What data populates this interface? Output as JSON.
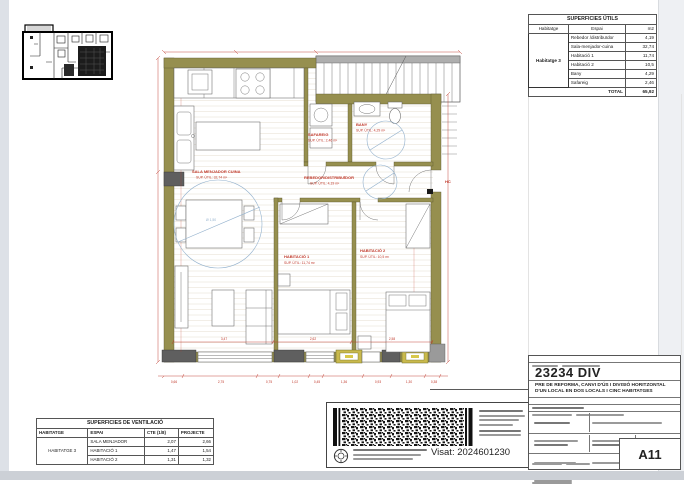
{
  "sheet": {
    "project_number": "23234 DIV",
    "project_description_line1": "PRE DE REFORMA, CANVI D'ÚS I DIVISIÓ HORITZONTAL",
    "project_description_line2": "D'UN LOCAL EN DOS LOCALS I CINC HABITATGES",
    "sheet_number": "A11",
    "visat": "Visat: 2024601230"
  },
  "surfaces_table": {
    "title": "SUPERFICIES ÚTILS",
    "columns": {
      "habitatge": "Habitatge",
      "espai": "Espai",
      "m2": "m2"
    },
    "habitatge": "Habitatge 3",
    "rows": [
      {
        "espai": "Rebedor /distribuïdor",
        "m2": "4,19"
      },
      {
        "espai": "Sala-menjador-cuina",
        "m2": "32,74"
      },
      {
        "espai": "Habitació 1",
        "m2": "11,74"
      },
      {
        "espai": "Habitació 2",
        "m2": "10,5"
      },
      {
        "espai": "Bany",
        "m2": "4,29"
      },
      {
        "espai": "Safareig",
        "m2": "2,46"
      }
    ],
    "total_label": "TOTAL",
    "total_value": "65,92"
  },
  "ventilation_table": {
    "title": "SUPERFICIES DE VENTILACIÓ",
    "columns": {
      "habitatge": "HABITATGE",
      "espai": "ESPAI",
      "cte": "CTE (1/8)",
      "projecte": "PROJECTE"
    },
    "habitatge": "HABITATGE 3",
    "rows": [
      {
        "espai": "SALA MENJADOR",
        "cte": "2,07",
        "projecte": "2,66"
      },
      {
        "espai": "HABITACIÓ 1",
        "cte": "1,47",
        "projecte": "1,54"
      },
      {
        "espai": "HABITACIÓ 2",
        "cte": "1,31",
        "projecte": "1,32"
      }
    ]
  },
  "plan": {
    "rooms": {
      "sala": {
        "name": "SALA MENJADOR CUINA",
        "area": "SUP. ÚTIL: 32,74 m²"
      },
      "rebedor": {
        "name": "REBEDOR/DISTRIBUÏDOR",
        "area": "SUP. ÚTIL: 4,19 m²"
      },
      "safareig": {
        "name": "SAFAREIG",
        "area": "SUP. ÚTIL: 2,46 m²"
      },
      "bany": {
        "name": "BANY",
        "area": "SUP. ÚTIL: 4,29 m²"
      },
      "habitacio1": {
        "name": "HABITACIÓ 1",
        "area": "SUP. ÚTIL: 11,74 m²"
      },
      "habitacio2": {
        "name": "HABITACIÓ 2",
        "area": "SUP. ÚTIL: 10,5 m²"
      }
    },
    "hc_label": "HC",
    "turning_circle_label": "Ø 1,50",
    "dims_bottom": [
      "0,66",
      "2,75",
      "0,75",
      "1,02",
      "0,45",
      "1,36",
      "0,93",
      "1,30",
      "0,38"
    ],
    "dims_inner": [
      "3,47",
      "2,62",
      "2,58"
    ]
  }
}
